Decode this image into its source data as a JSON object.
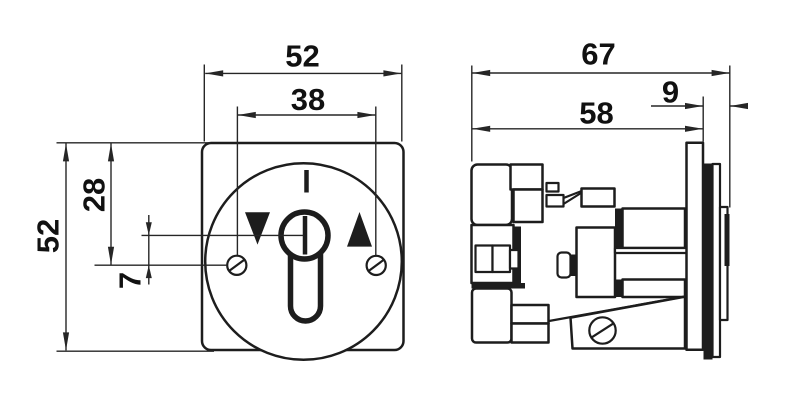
{
  "drawing": {
    "background": "#ffffff",
    "line_color": "#1d1d1d",
    "front_view": {
      "dimensions": {
        "width": "52",
        "screw_spacing": "38",
        "height": "52",
        "top_to_screw_axis": "28",
        "key_axis_to_screw_axis": "7"
      }
    },
    "side_view": {
      "dimensions": {
        "total_depth": "67",
        "rear_depth": "58",
        "front_protrusion": "9"
      }
    }
  }
}
